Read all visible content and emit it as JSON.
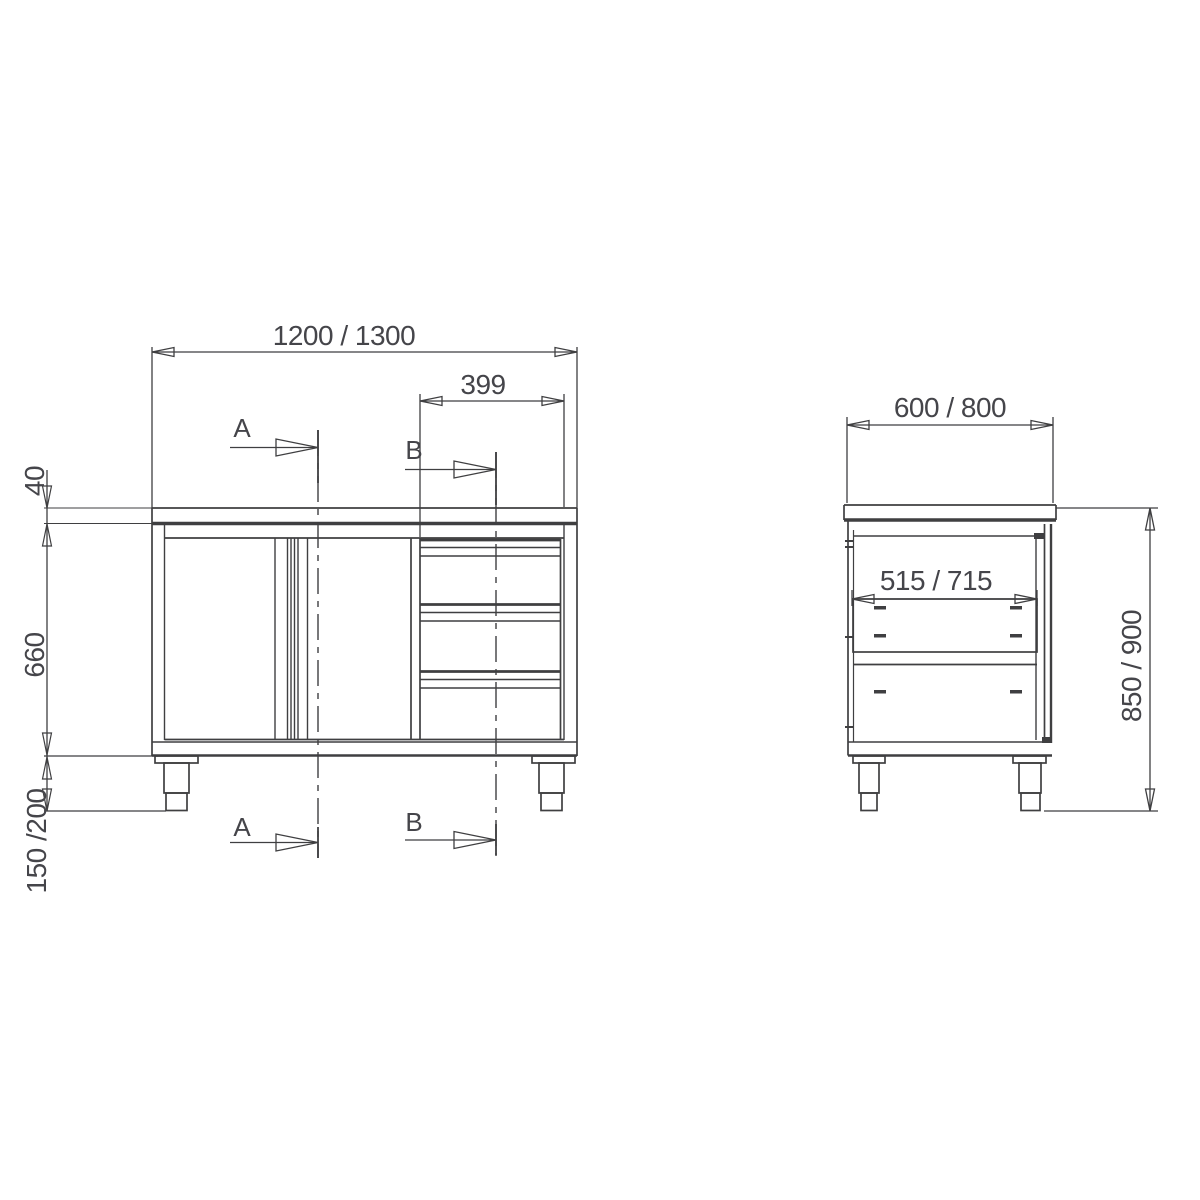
{
  "front_view": {
    "width_label": "1200 / 1300",
    "drawer_unit_width_label": "399",
    "worktop_thickness_label": "40",
    "body_height_label": "660",
    "leg_height_label": "150 /200",
    "section_a_label": "A",
    "section_b_label": "B"
  },
  "side_view": {
    "depth_label": "600 / 800",
    "inner_depth_label": "515 / 715",
    "overall_height_label": "850 / 900"
  },
  "colors": {
    "line": "#3f3f41",
    "text": "#45454a",
    "background": "#ffffff"
  }
}
